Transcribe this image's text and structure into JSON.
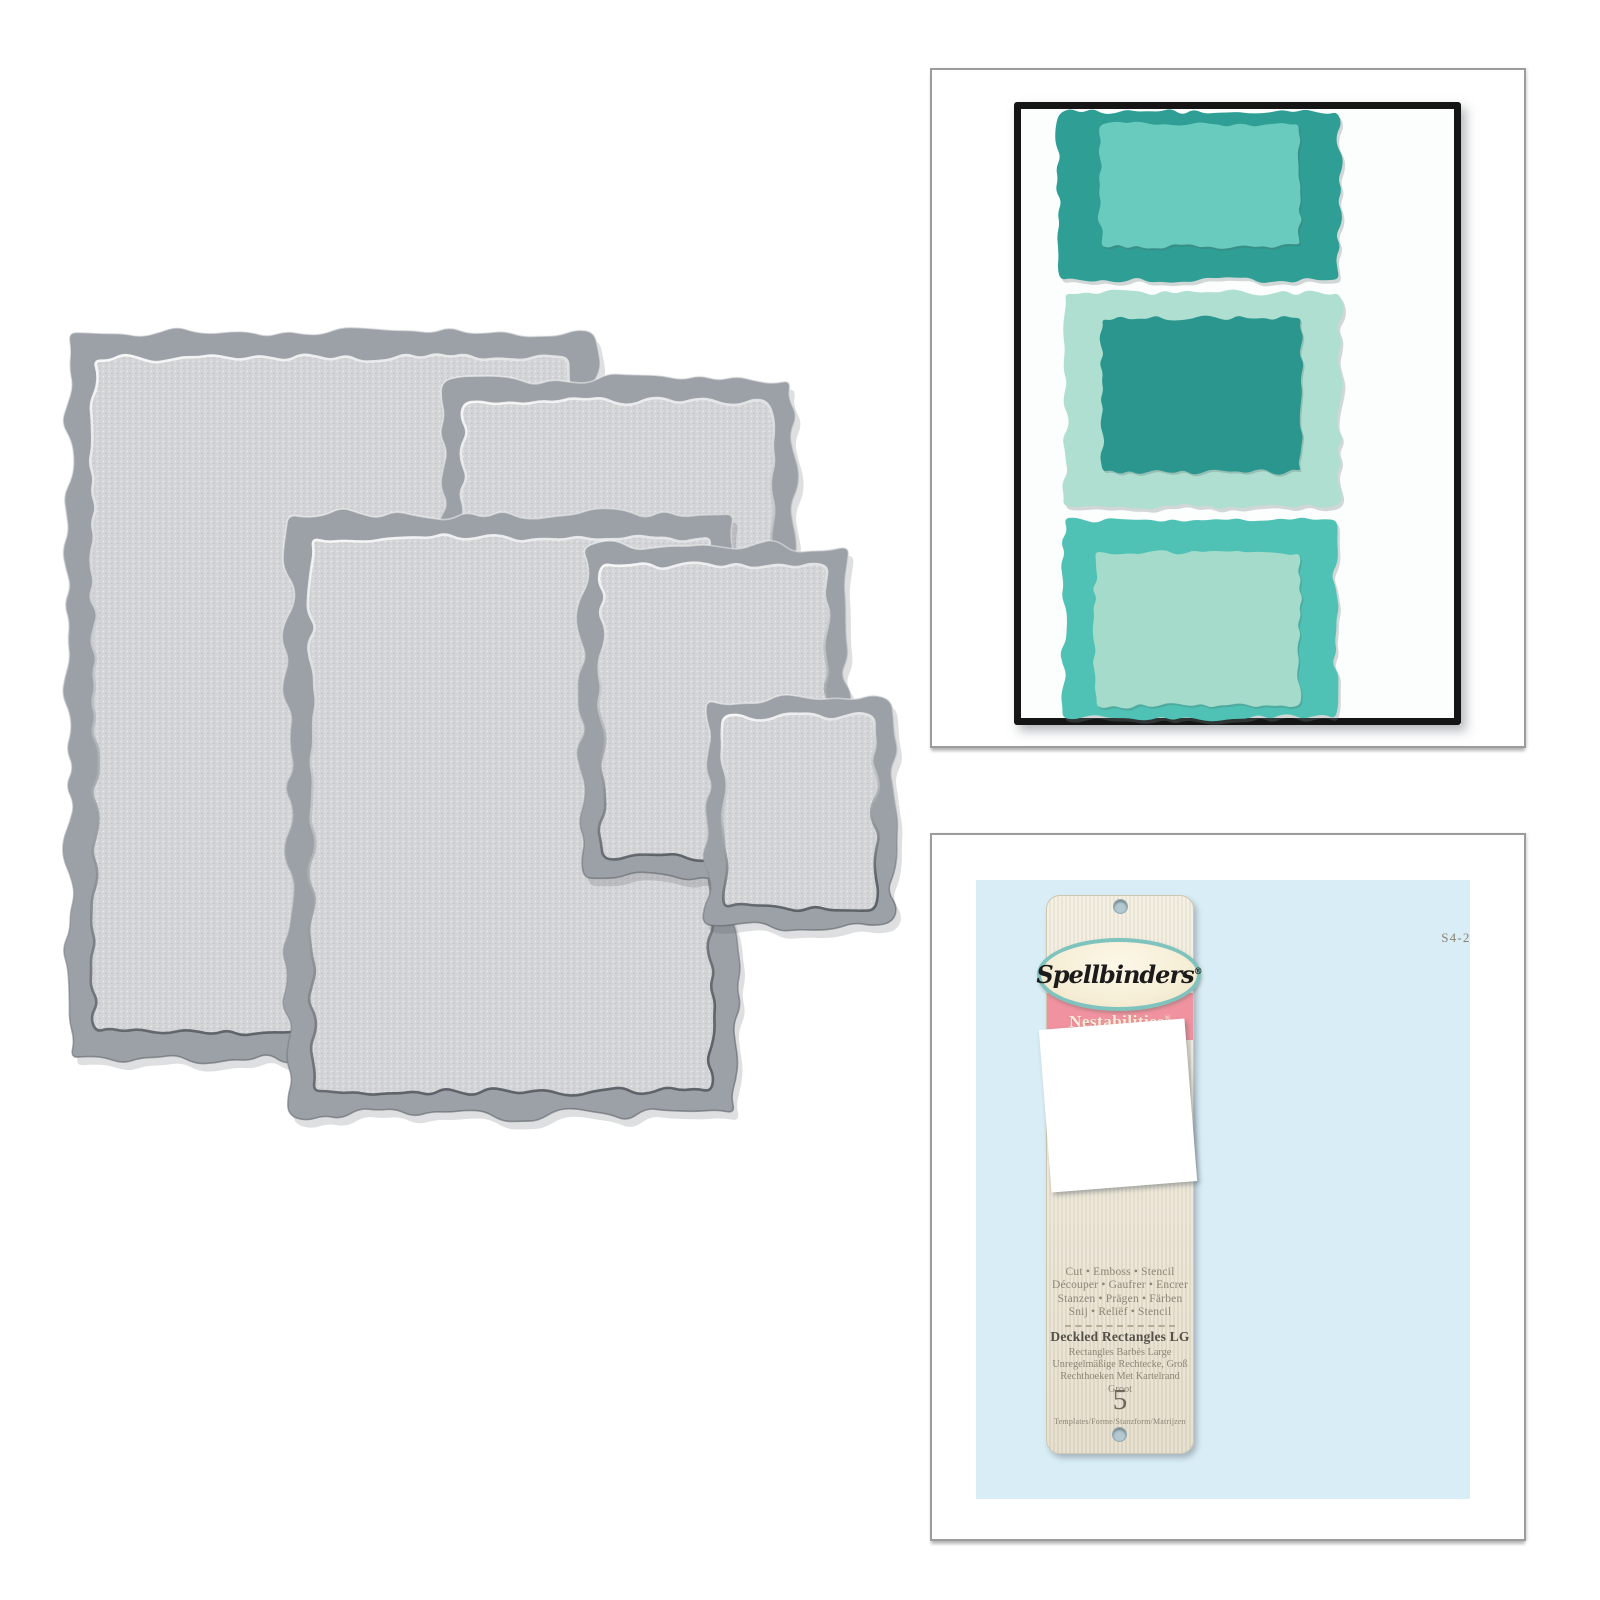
{
  "product": {
    "brand": "Spellbinders",
    "series": "Nestabilities",
    "reg_mark": "®",
    "item_code": "S4-202",
    "title": "Deckled Rectangles LG",
    "title_translations": [
      "Rectangles Barbés Large",
      "Unregelmäßige Rechtecke, Groß",
      "Rechthoeken Met Kartelrand Groot"
    ],
    "features": [
      "Cut • Emboss • Stencil",
      "Découper • Gaufrer • Encrer",
      "Stanzen • Prägen • Färben",
      "Snij • Reliëf • Stencil"
    ],
    "template_count": "5",
    "template_count_caption": "Templates/Forme/Stanzform/Matrijzen"
  },
  "badge": {
    "line1": "HAPPILY",
    "line2": "ever",
    "line3": "AFTER"
  },
  "colors": {
    "die_frame": "#9ca1a7",
    "die_surface": "#d3d5d7",
    "teal_dark": "#2f9e95",
    "teal_light": "#68cbbd",
    "mint": "#aedfd1",
    "mint_soft": "#a4dbca",
    "turquoise": "#4fc2b5",
    "kraft": "#c8a17b",
    "kraft_line": "#8d6947",
    "blue_bg": "#d9edf6",
    "swirl": "#c5e2f0",
    "pink": "#f0929f",
    "cream": "#f6eed6",
    "twine": "#8a6a49",
    "badge_black": "#1a1a18"
  },
  "dies": {
    "items": [
      {
        "x": 38,
        "y": 32,
        "w": 527,
        "h": 726,
        "band": 26,
        "seed": 11
      },
      {
        "x": 412,
        "y": 80,
        "w": 350,
        "h": 482,
        "band": 22,
        "seed": 22
      },
      {
        "x": 258,
        "y": 214,
        "w": 447,
        "h": 601,
        "band": 24,
        "seed": 33
      },
      {
        "x": 552,
        "y": 246,
        "w": 264,
        "h": 332,
        "band": 20,
        "seed": 44
      },
      {
        "x": 676,
        "y": 400,
        "w": 186,
        "h": 225,
        "band": 17,
        "seed": 55
      }
    ]
  },
  "card": {
    "frame_color": "#151515",
    "paper_color": "#fcfdfd",
    "groups": [
      {
        "outer": {
          "x": 45,
          "y": 10,
          "w": 280,
          "h": 168,
          "color": "#2f9e95"
        },
        "inner": {
          "x": 86,
          "y": 22,
          "w": 200,
          "h": 122,
          "color": "#68cbbd"
        }
      },
      {
        "outer": {
          "x": 51,
          "y": 191,
          "w": 275,
          "h": 213,
          "color": "#aedfd1"
        },
        "inner": {
          "x": 88,
          "y": 216,
          "w": 199,
          "h": 154,
          "color": "#2b968e"
        }
      },
      {
        "outer": {
          "x": 50,
          "y": 418,
          "w": 271,
          "h": 198,
          "color": "#4fc2b5"
        },
        "inner": {
          "x": 81,
          "y": 451,
          "w": 205,
          "h": 153,
          "color": "#a4dbca"
        }
      }
    ],
    "flowers": [
      {
        "cx": 100,
        "cy": 215,
        "r": 55,
        "rot": 12
      },
      {
        "cx": 151,
        "cy": 312,
        "r": 56,
        "rot": -30
      },
      {
        "cx": 146,
        "cy": 493,
        "r": 50,
        "rot": 54
      }
    ],
    "badge_geom": {
      "cx": 245,
      "cy": 458,
      "r": 51
    }
  },
  "package": {
    "frames_center": {
      "x": 311,
      "y": 326
    },
    "frames": [
      {
        "w": 265,
        "h": 352,
        "band": 15,
        "seed": 71
      },
      {
        "w": 212,
        "h": 282,
        "band": 14,
        "seed": 72
      },
      {
        "w": 164,
        "h": 218,
        "band": 13,
        "seed": 73
      },
      {
        "w": 124,
        "h": 164,
        "band": 12,
        "seed": 74
      },
      {
        "w": 88,
        "h": 112,
        "band": 11,
        "seed": 75
      }
    ]
  }
}
